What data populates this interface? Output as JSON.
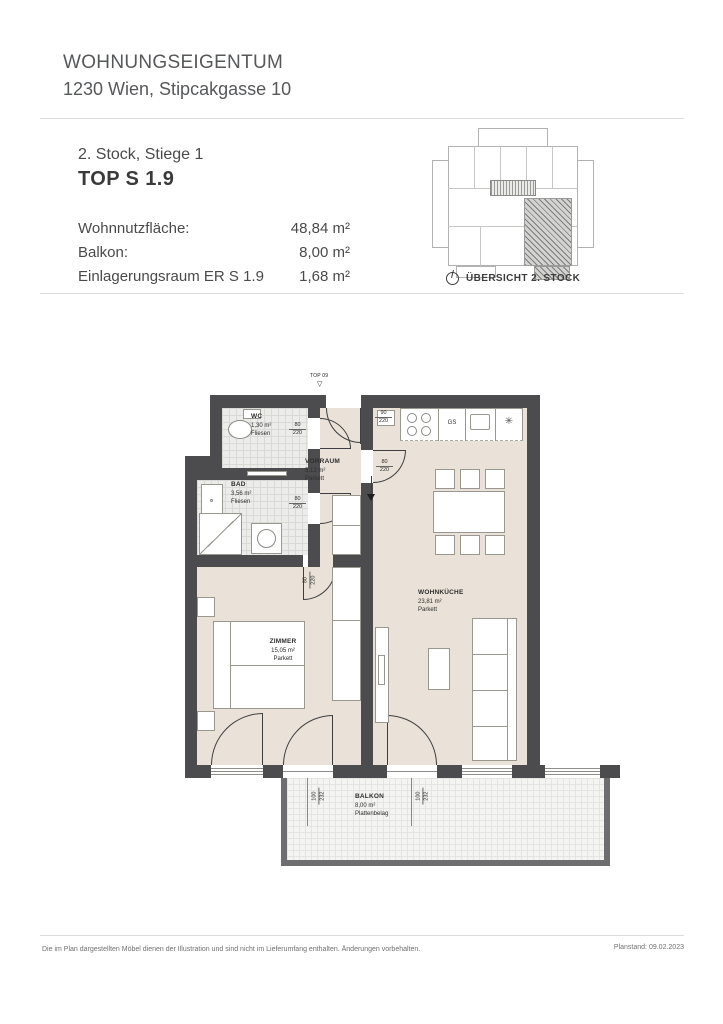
{
  "header": {
    "title": "WOHNUNGSEIGENTUM",
    "address": "1230 Wien, Stipcakgasse 10"
  },
  "info": {
    "floor_line": "2. Stock, Stiege 1",
    "unit_line": "TOP S 1.9",
    "rows": [
      {
        "label": "Wohnnutzfläche:",
        "value": "48,84 m²"
      },
      {
        "label": "Balkon:",
        "value": "8,00 m²"
      },
      {
        "label": "Einlagerungsraum ER S 1.9",
        "value": "1,68 m²"
      }
    ]
  },
  "overview": {
    "caption": "ÜBERSICHT 2. STOCK"
  },
  "plan": {
    "entrance": {
      "label": "TOP 09",
      "marker": "▽",
      "dim_w": "90",
      "dim_h": "220"
    },
    "rooms": {
      "wc": {
        "name": "WC",
        "area": "1,30 m²",
        "floor": "Fliesen"
      },
      "bad": {
        "name": "BAD",
        "area": "3,56 m²",
        "floor": "Fliesen"
      },
      "vorraum": {
        "name": "VORRAUM",
        "area": "5,12 m²",
        "floor": "Parkett"
      },
      "zimmer": {
        "name": "ZIMMER",
        "area": "15,05 m²",
        "floor": "Parkett"
      },
      "wohnkueche": {
        "name": "WOHNKÜCHE",
        "area": "23,81 m²",
        "floor": "Parkett"
      },
      "balkon": {
        "name": "BALKON",
        "area": "8,00 m²",
        "floor": "Plattenbelag"
      }
    },
    "labels": {
      "dishwasher": "GS",
      "light_symbol": "✳"
    },
    "dims": {
      "door_w": "80",
      "door_h": "220",
      "bdoor_w": "100",
      "bdoor_h": "232"
    }
  },
  "footer": {
    "disclaimer": "Die im Plan dargestellten Möbel dienen der Illustration und sind nicht im Lieferumfang enthalten. Änderungen vorbehalten.",
    "planstand_label": "Planstand:",
    "planstand_date": "09.02.2023"
  },
  "colors": {
    "wall": "#4c4c4f",
    "floor_parquet": "#eae2d8",
    "floor_tile": "#ececea",
    "balcony": "#f4f4f2",
    "rule": "#dcdcda"
  }
}
